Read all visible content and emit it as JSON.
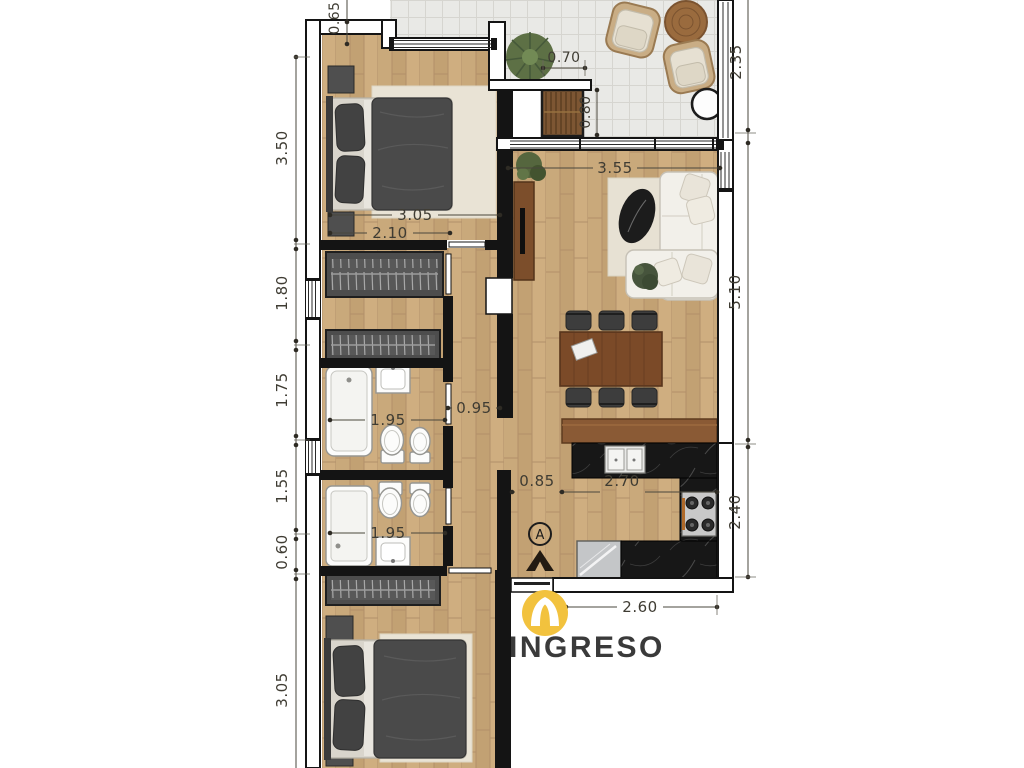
{
  "entry": {
    "label": "INGRESO",
    "section_marker": "A"
  },
  "dimensions": {
    "top_offset": "0.65",
    "left_chain": [
      "3.50",
      "1.80",
      "1.75",
      "1.55",
      "0.60",
      "3.05"
    ],
    "right_chain": [
      "2.35",
      "5.10",
      "2.40"
    ],
    "terrace": {
      "screen_width": "0.70",
      "screen_depth": "0.80"
    },
    "living": {
      "width": "3.55"
    },
    "bedroom1": {
      "width": "3.05",
      "closet_span": "2.10"
    },
    "bathroom1": {
      "width": "1.95"
    },
    "corridor": {
      "width": "0.95"
    },
    "bathroom2": {
      "width": "1.95"
    },
    "kitchen": {
      "passage": "0.85",
      "counter_run": "2.70",
      "entry_width": "2.60"
    }
  },
  "colors": {
    "wood_floor": "#c9a97b",
    "terrace_tile": "#e9e9e6",
    "wall": "#141414",
    "counter_marble": "#171717",
    "logo_yellow": "#f2c23e",
    "dim_text": "#3f3c33"
  }
}
